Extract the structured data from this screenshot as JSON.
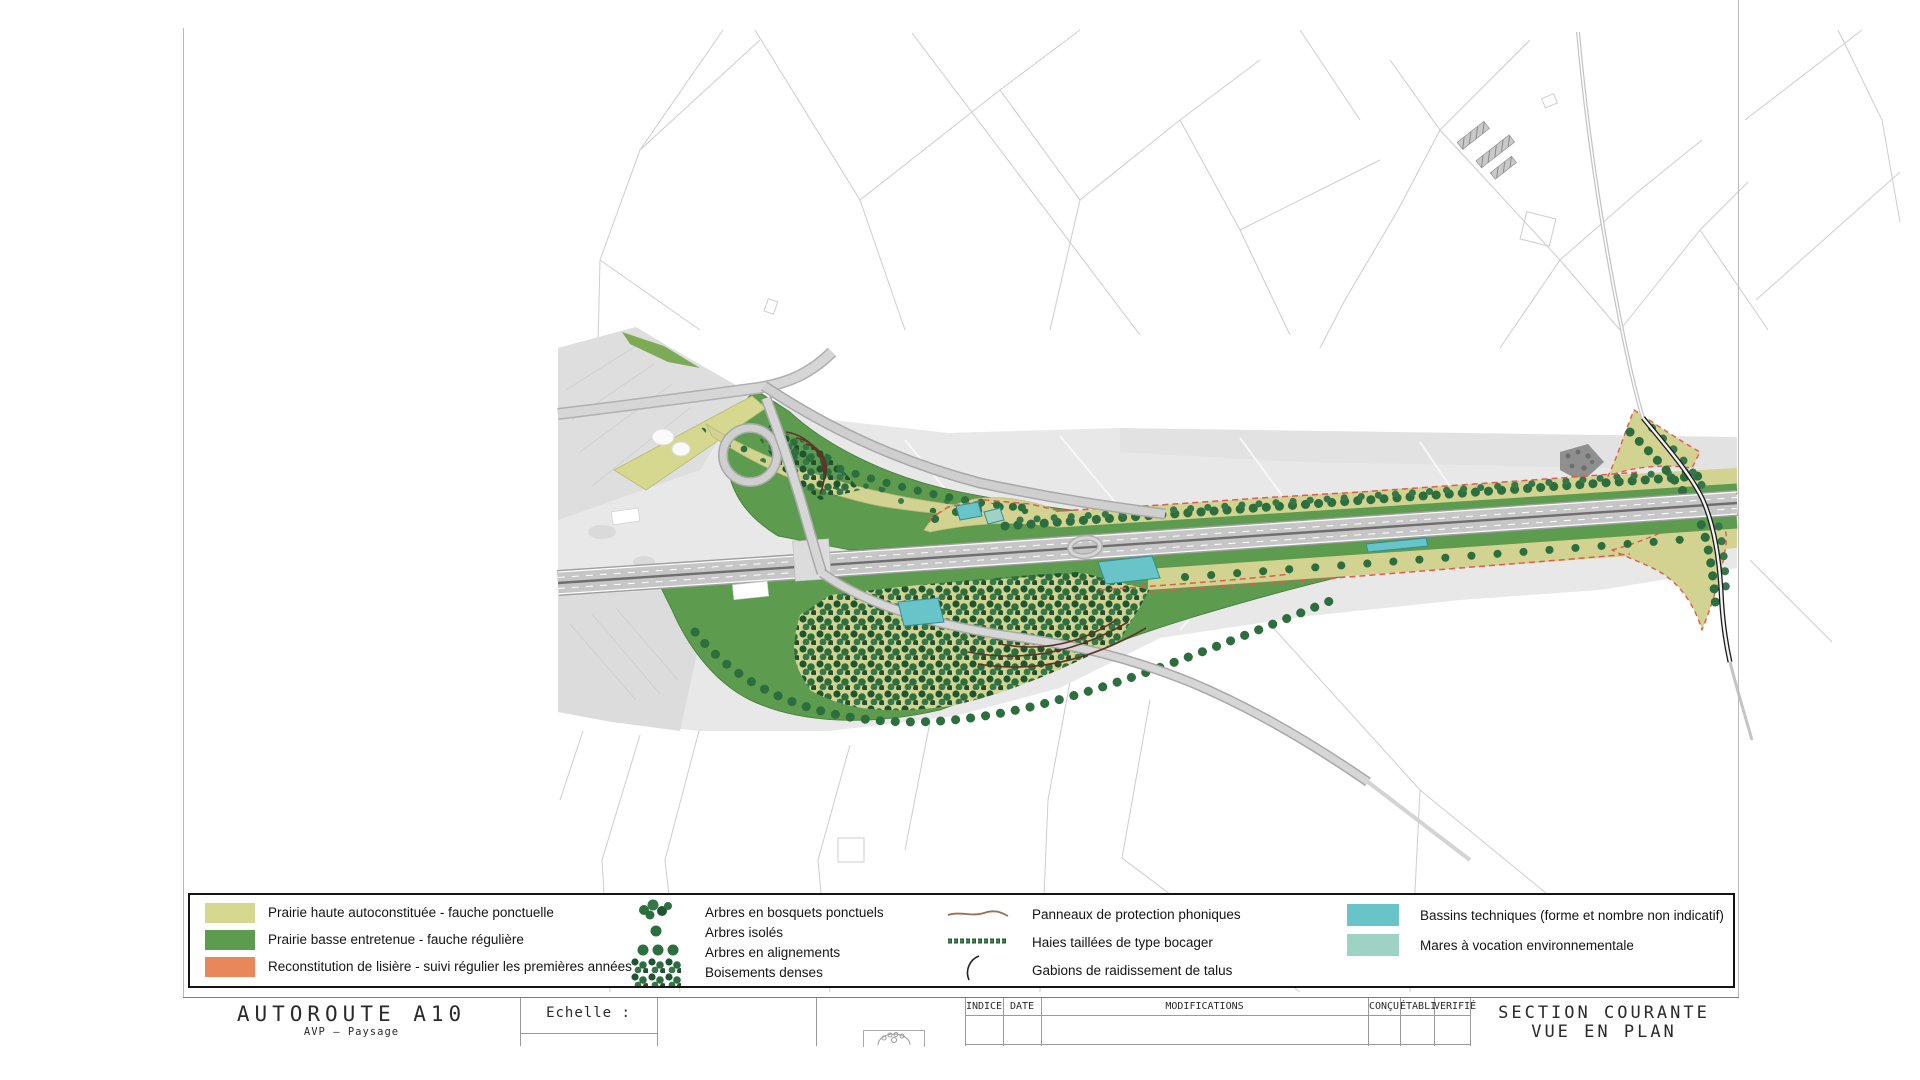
{
  "sheet": {
    "legend": {
      "surfaces": [
        {
          "label": "Prairie haute autoconstituée - fauche ponctuelle",
          "color": "#d6d88f"
        },
        {
          "label": "Prairie basse entretenue - fauche régulière",
          "color": "#5d9b4e"
        },
        {
          "label": "Reconstitution de lisière - suivi régulier les premières années",
          "color": "#e8875a"
        }
      ],
      "vegetation": [
        {
          "label": "Arbres en bosquets ponctuels",
          "symbol": "tree-cluster"
        },
        {
          "label": "Arbres isolés",
          "symbol": "single-tree"
        },
        {
          "label": "Arbres en alignements",
          "symbol": "tree-row"
        },
        {
          "label": "Boisements denses",
          "symbol": "dense-woods"
        }
      ],
      "linework": [
        {
          "label": "Panneaux de protection phoniques",
          "symbol": "brown-line"
        },
        {
          "label": "Haies taillées de type bocager",
          "symbol": "green-hedge-line"
        },
        {
          "label": "Gabions de raidissement de talus",
          "symbol": "curved-arc"
        }
      ],
      "water": [
        {
          "label": "Bassins techniques (forme et nombre non indicatif)",
          "color": "#68c4c9"
        },
        {
          "label": "Mares à vocation environnementale",
          "color": "#9ed3c4"
        }
      ]
    },
    "title_block": {
      "project_title": "AUTOROUTE A10",
      "project_subtitle": "AVP – Paysage",
      "scale_label": "Echelle :",
      "revision_table": {
        "headers": [
          "INDICE",
          "DATE",
          "MODIFICATIONS",
          "CONÇU",
          "ÉTABLI",
          "VERIFIÉ"
        ]
      },
      "drawing_title_line1": "SECTION COURANTE",
      "drawing_title_line2": "VUE EN PLAN"
    },
    "colors": {
      "prairie_haute": "#d6d88f",
      "prairie_basse": "#5d9b4e",
      "lisiere": "#e8875a",
      "bassin": "#68c4c9",
      "mare": "#9ed3c4",
      "tree_dark": "#2c6e3e",
      "gabion": "#5f3325",
      "panneau": "#9a7050",
      "emprise_dash": "#e05a52"
    }
  }
}
